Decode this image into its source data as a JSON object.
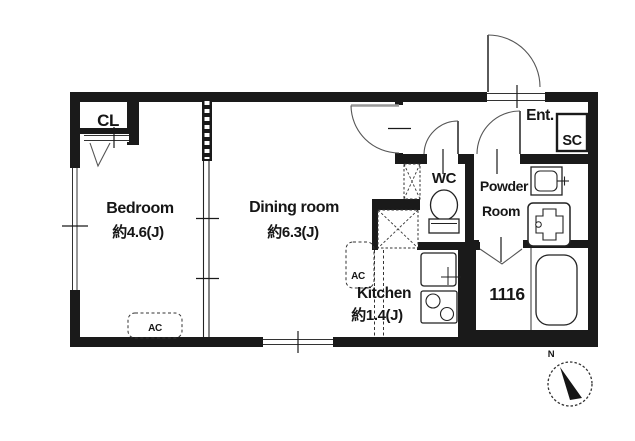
{
  "rooms": {
    "closet": {
      "label": "CL"
    },
    "bedroom": {
      "label": "Bedroom",
      "size": "約4.6(J)",
      "ac_label": "AC"
    },
    "dining_room": {
      "label": "Dining room",
      "size": "約6.3(J)"
    },
    "kitchen": {
      "label": "Kitchen",
      "size": "約1.4(J)",
      "ac_label": "AC"
    },
    "wc": {
      "label": "WC"
    },
    "powder_room": {
      "label_line1": "Powder",
      "label_line2": "Room"
    },
    "bathroom": {
      "tub_label": "1116"
    },
    "entrance": {
      "label": "Ent."
    },
    "shoe_closet": {
      "label": "SC"
    }
  },
  "compass": {
    "north_label": "N"
  },
  "colors": {
    "wall": "#1a1a1a",
    "thin_line": "#333333",
    "door_leaf": "#999999",
    "background": "#ffffff"
  }
}
